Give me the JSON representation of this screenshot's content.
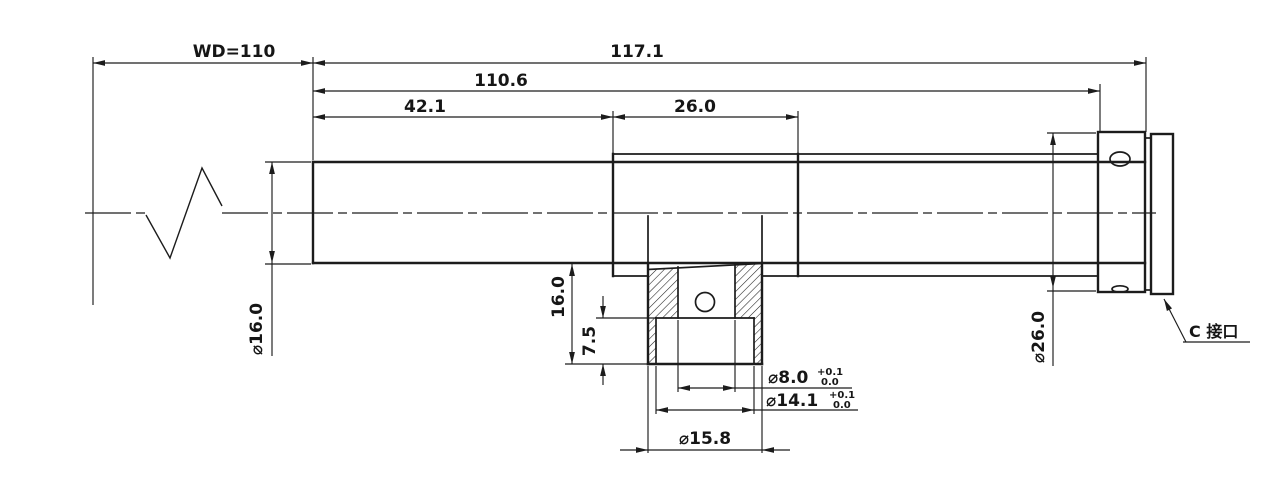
{
  "drawing": {
    "type": "mechanical-engineering-drawing",
    "subject": "telecentric lens with coaxial illumination port and C-mount",
    "colors": {
      "line": "#1c1c1c",
      "background": "#ffffff"
    },
    "dimensions": {
      "working_distance": {
        "value": "WD=110"
      },
      "total_length": {
        "value": "117.1"
      },
      "housing_length": {
        "value": "110.6"
      },
      "front_segment_length": {
        "value": "42.1"
      },
      "port_segment_length": {
        "value": "26.0"
      },
      "barrel_diameter": {
        "value": "⌀16.0"
      },
      "port_height": {
        "value": "16.0"
      },
      "port_step_depth": {
        "value": "7.5"
      },
      "port_bore": {
        "value": "⌀8.0",
        "tol_upper": "+0.1",
        "tol_lower": "0.0"
      },
      "port_counterbore": {
        "value": "⌀14.1",
        "tol_upper": "+0.1",
        "tol_lower": "0.0"
      },
      "port_outer_diameter": {
        "value": "⌀15.8"
      },
      "mount_body_diameter": {
        "value": "⌀26.0"
      }
    },
    "annotations": {
      "c_mount_label": "C 接口"
    }
  }
}
